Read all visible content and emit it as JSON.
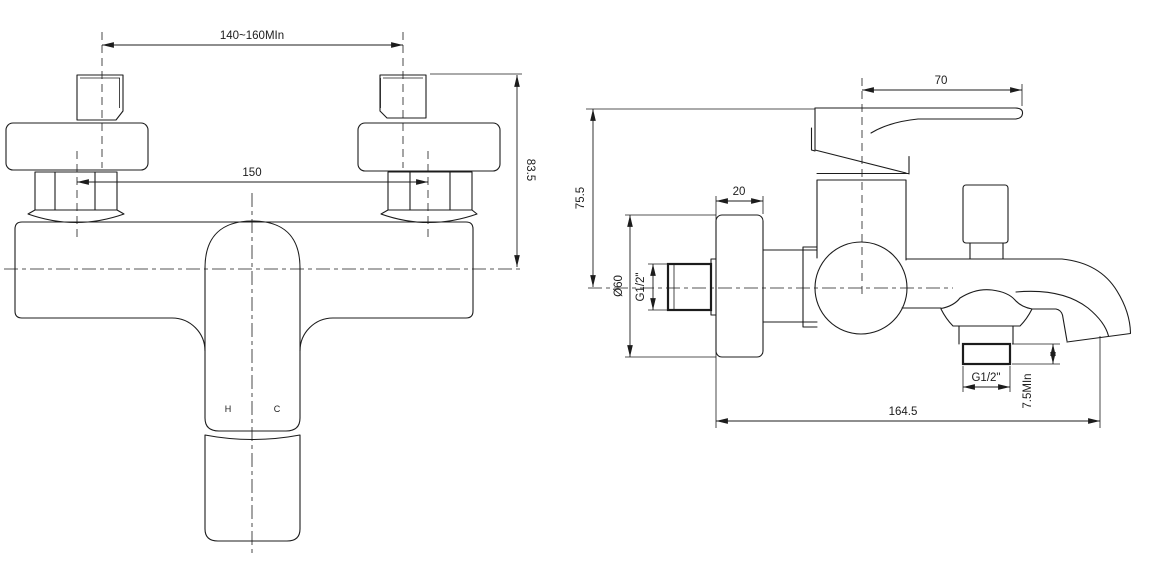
{
  "colors": {
    "background": "#ffffff",
    "line": "#1c1c1c"
  },
  "front_view": {
    "title": "front view",
    "dim_wall_centers": "140~160MIn",
    "dim_inlet_centers": "150",
    "dim_top_to_axis": "83.5",
    "label_hot": "H",
    "label_cold": "C"
  },
  "side_view": {
    "title": "side view",
    "dim_handle_length": "70",
    "dim_top_to_axis": "75.5",
    "dim_escutcheon_depth": "20",
    "dim_escutcheon_dia": "Ø60",
    "dim_inlet_thread": "G1/2\"",
    "dim_outlet_thread": "G1/2\"",
    "dim_outlet_thread_len": "7.5MIn",
    "dim_overall_depth": "164.5"
  }
}
